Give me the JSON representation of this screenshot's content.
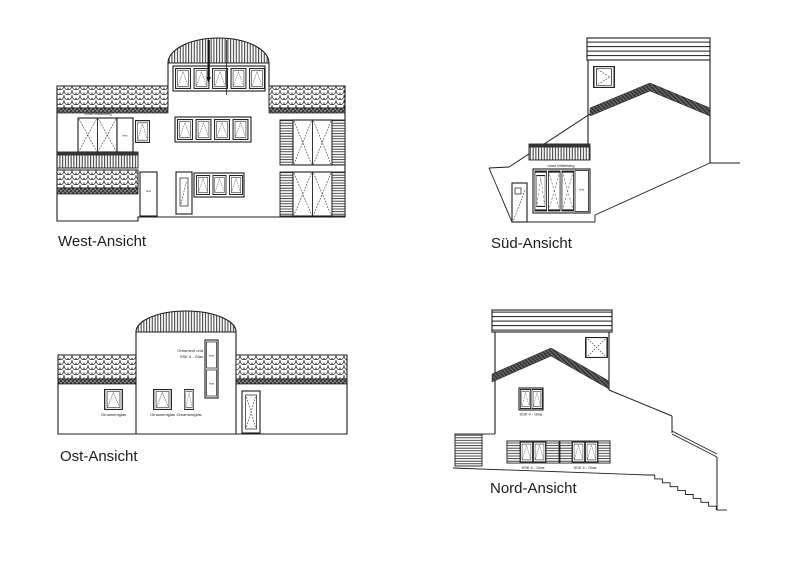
{
  "sheet": {
    "background": "#ffffff",
    "ink": "#1c1c1c"
  },
  "views": {
    "west": {
      "label": "West-Ansicht",
      "annotations": {
        "no_mullion": "ohne Mittelsteg",
        "fixed_panel": "fest",
        "fixed_door": "fest"
      }
    },
    "sued": {
      "label": "Süd-Ansicht",
      "annotations": {
        "no_mullion": "ohne Mittelsteg",
        "fixed_panel": "fest"
      }
    },
    "ost": {
      "label": "Ost-Ansicht",
      "annotations": {
        "ornament_line1": "Ornament und",
        "ornament_line2": "SSK 4 - Glas",
        "fixed_upper": "fest",
        "fixed_lower": "fest",
        "ornament_glass_left": "Ornamentglas",
        "ornament_glass_mid": "Ornamentglas",
        "ornament_glass_right": "Ornamentglas"
      }
    },
    "nord": {
      "label": "Nord-Ansicht",
      "annotations": {
        "glass_mid": "SSK 4 - Glas",
        "glass_left": "SSK 4 - Glas",
        "glass_right": "SSK 4 - Glas"
      }
    }
  }
}
